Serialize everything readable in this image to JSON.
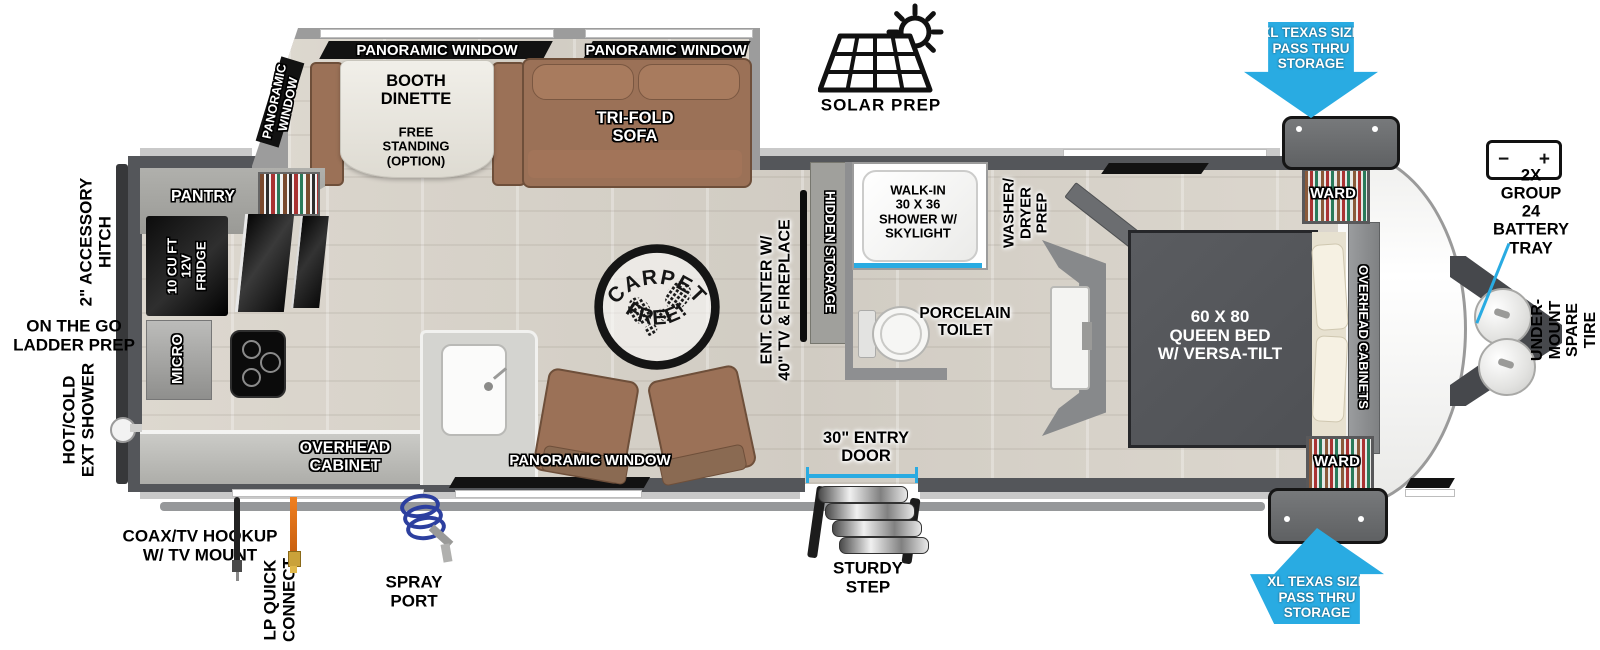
{
  "colors": {
    "accent_blue": "#29abe2",
    "wall_gray": "#54565a",
    "furniture_brown": "#9b7157",
    "bed_gray": "#55575b"
  },
  "exterior": {
    "solar_prep": "SOLAR PREP",
    "pass_thru": "XL TEXAS SIZE\nPASS THRU\nSTORAGE",
    "battery_tray": "2X GROUP 24\nBATTERY\nTRAY",
    "battery_minus": "−",
    "battery_plus": "+",
    "spare_tire": "UNDER-MOUNT\nSPARE TIRE",
    "accessory_hitch": "2\" ACCESSORY\nHITCH",
    "ladder_prep": "ON THE GO\nLADDER PREP",
    "ext_shower": "HOT/COLD\nEXT SHOWER",
    "coax": "COAX/TV HOOKUP\nW/ TV MOUNT",
    "lp": "LP QUICK\nCONNECT",
    "spray_port": "SPRAY\nPORT",
    "entry_door": "30\" ENTRY\nDOOR",
    "step": "STURDY\nSTEP"
  },
  "interior": {
    "panoramic_window": "PANORAMIC WINDOW",
    "panoramic_window_vert": "PANORAMIC\nWINDOW",
    "booth_dinette": "BOOTH\nDINETTE",
    "free_standing": "FREE\nSTANDING\n(OPTION)",
    "sofa": "TRI-FOLD\nSOFA",
    "pantry": "PANTRY",
    "fridge": "10 CU FT\n12V\nFRIDGE",
    "micro": "MICRO",
    "overhead_cabinet": "OVERHEAD\nCABINET",
    "ent_center": "ENT. CENTER W/\n40\" TV & FIREPLACE",
    "hidden_storage": "HIDDEN STORAGE",
    "shower": "WALK-IN\n30 X 36\nSHOWER W/\nSKYLIGHT",
    "toilet": "PORCELAIN\nTOILET",
    "washer_dryer": "WASHER/\nDRYER\nPREP",
    "bed": "60 X 80\nQUEEN BED\nW/ VERSA-TILT",
    "overhead_cabinets": "OVERHEAD CABINETS",
    "ward": "WARD",
    "carpet_top": "CARPET",
    "carpet_bottom": "FREE!"
  }
}
